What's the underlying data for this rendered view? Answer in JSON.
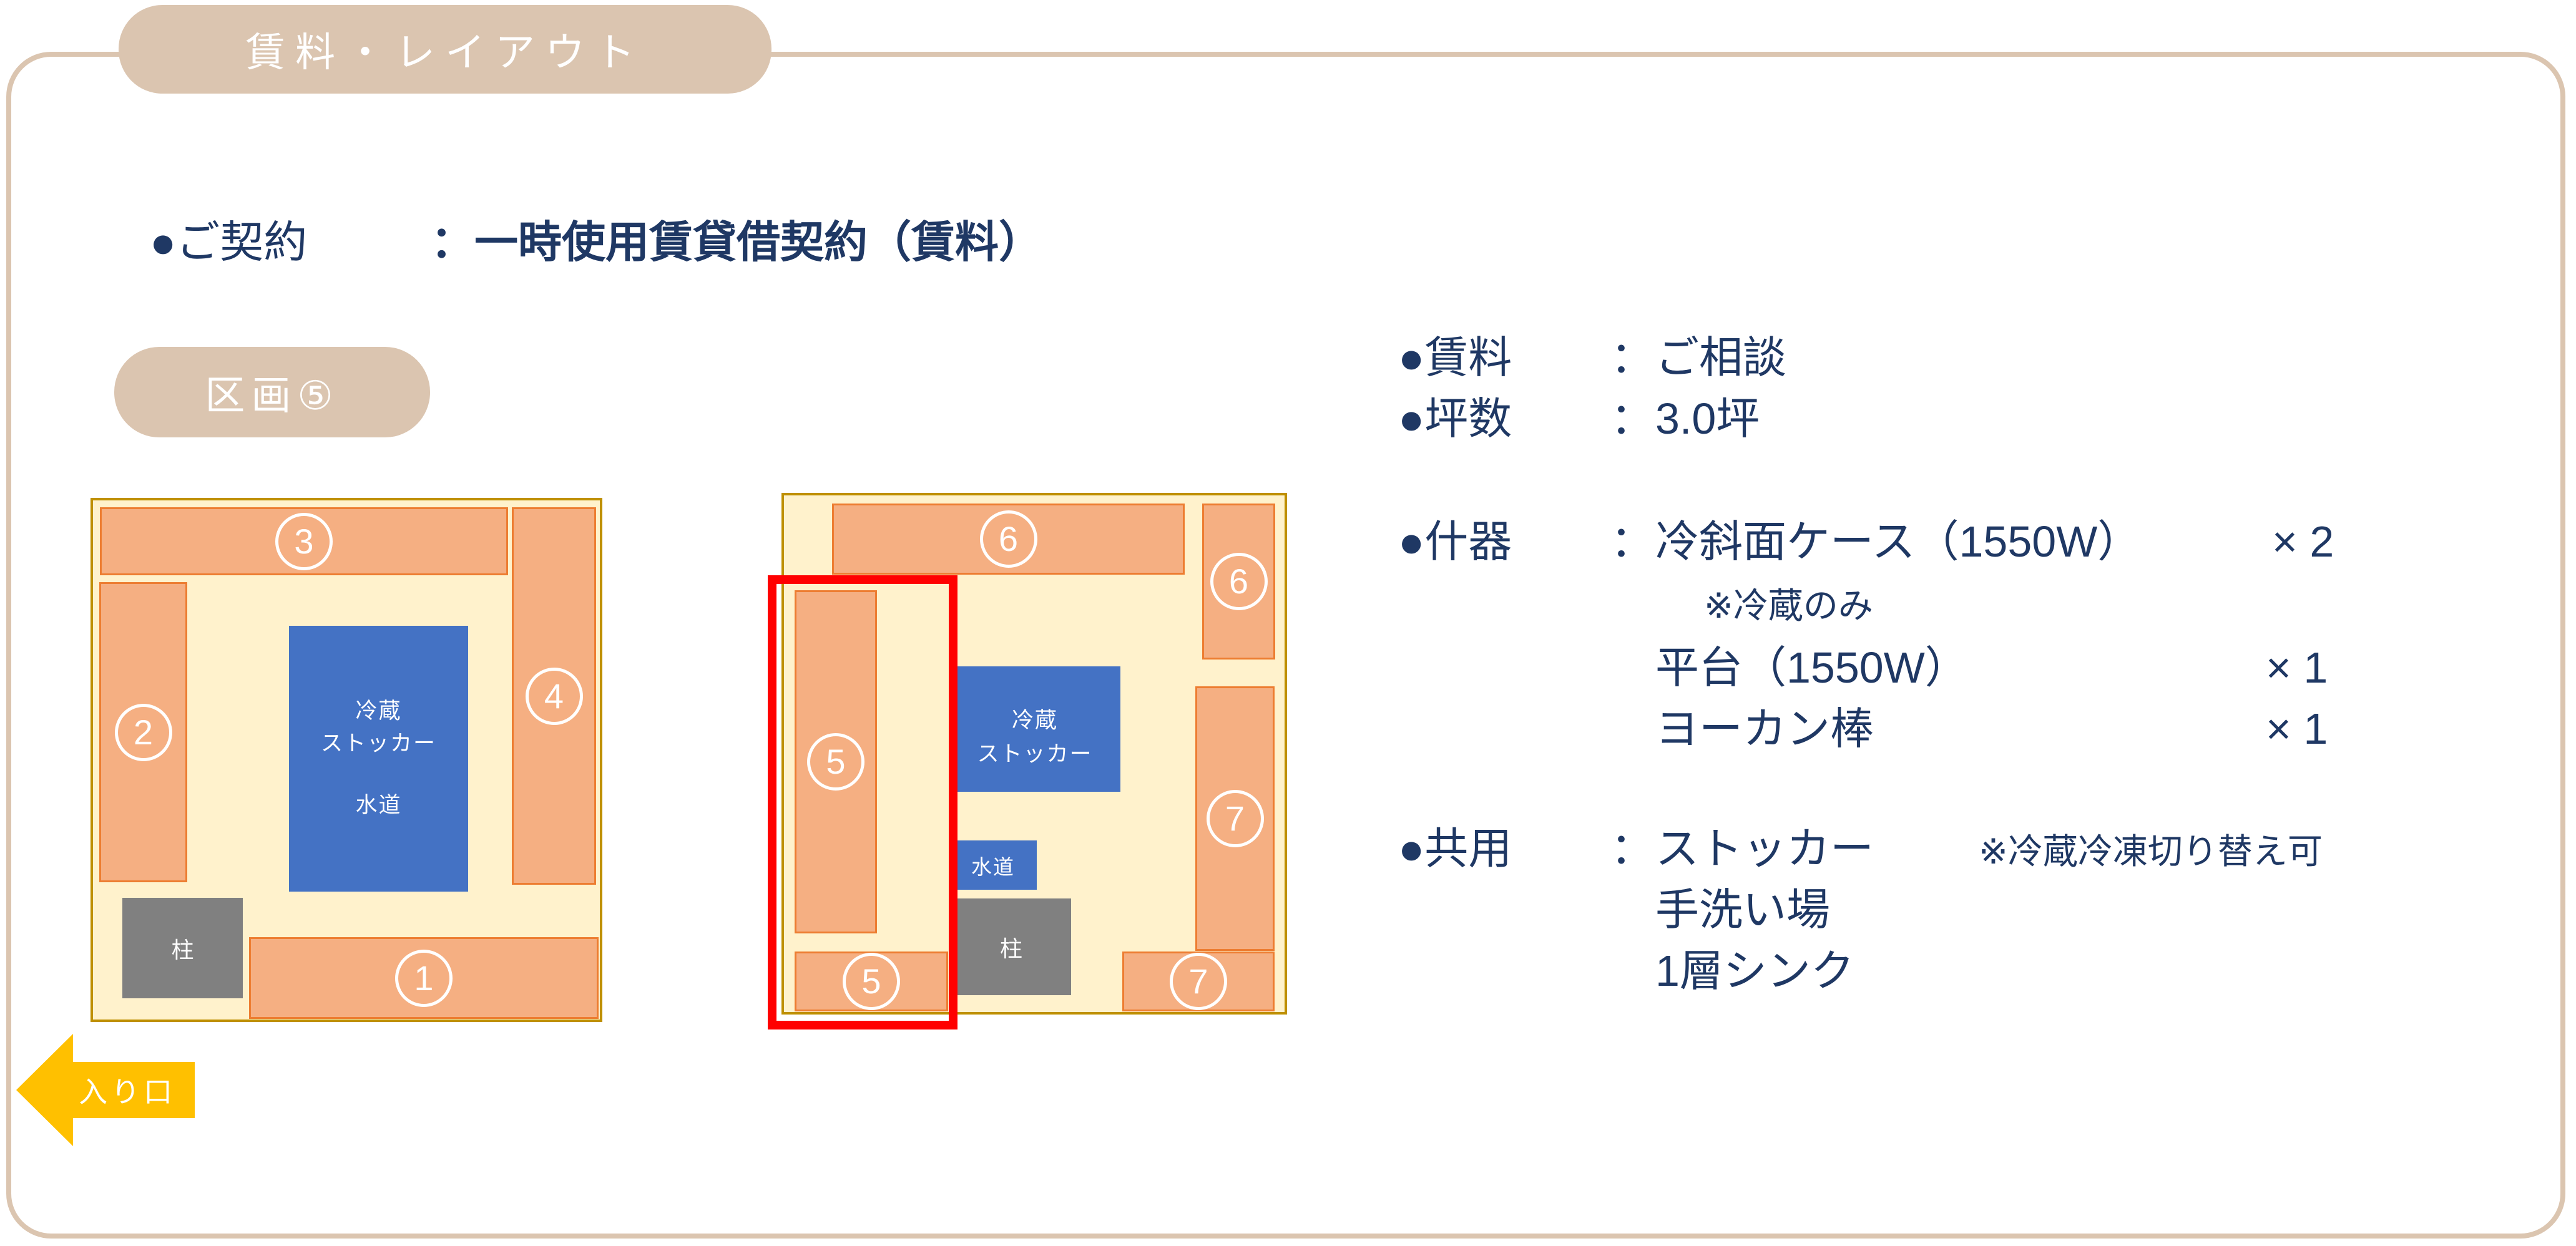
{
  "tab": {
    "title": "賃料・レイアウト"
  },
  "contract": {
    "label": "●ご契約",
    "colon": "：",
    "value": "一時使用賃貸借契約（賃料）"
  },
  "badge": {
    "label": "区画⑤"
  },
  "info": {
    "rent": {
      "label": "●賃料",
      "colon": "：",
      "value": "ご相談"
    },
    "area": {
      "label": "●坪数",
      "colon": "：",
      "value": "3.0坪"
    },
    "fixtures": {
      "label": "●什器",
      "colon": "：",
      "value": "冷斜面ケース（1550W）",
      "qty": "× 2",
      "note": "※冷蔵のみ",
      "item2": {
        "name": "平台（1550W）",
        "qty": "× 1"
      },
      "item3": {
        "name": "ヨーカン棒",
        "qty": "× 1"
      }
    },
    "shared": {
      "label": "●共用",
      "colon": "：",
      "value": "ストッカー",
      "note": "※冷蔵冷凍切り替え可",
      "item2": "手洗い場",
      "item3": "1層シンク"
    }
  },
  "plan_left": {
    "labels": {
      "b1": "1",
      "b2": "2",
      "b3": "3",
      "b4": "4"
    },
    "stocker": {
      "line1": "冷蔵",
      "line2": "ストッカー",
      "line3": "水道"
    },
    "pillar": "柱"
  },
  "plan_right": {
    "labels": {
      "top6": "6",
      "side6": "6",
      "tall5": "5",
      "bottom5": "5",
      "side7": "7",
      "bottom7": "7"
    },
    "stocker": {
      "line1": "冷蔵",
      "line2": "ストッカー"
    },
    "water": "水道",
    "pillar": "柱"
  },
  "entrance": {
    "label": "入り口"
  },
  "colors": {
    "tan": "#DBC5B0",
    "navy_text": "#1F3864",
    "plan_bg": "#FFF2CC",
    "plan_border": "#BF9000",
    "bar_fill": "#F5AF82",
    "bar_border": "#ED7D31",
    "blue": "#4472C4",
    "pillar_gray": "#808080",
    "highlight_red": "#FF0000",
    "arrow_yellow": "#FFC000"
  }
}
